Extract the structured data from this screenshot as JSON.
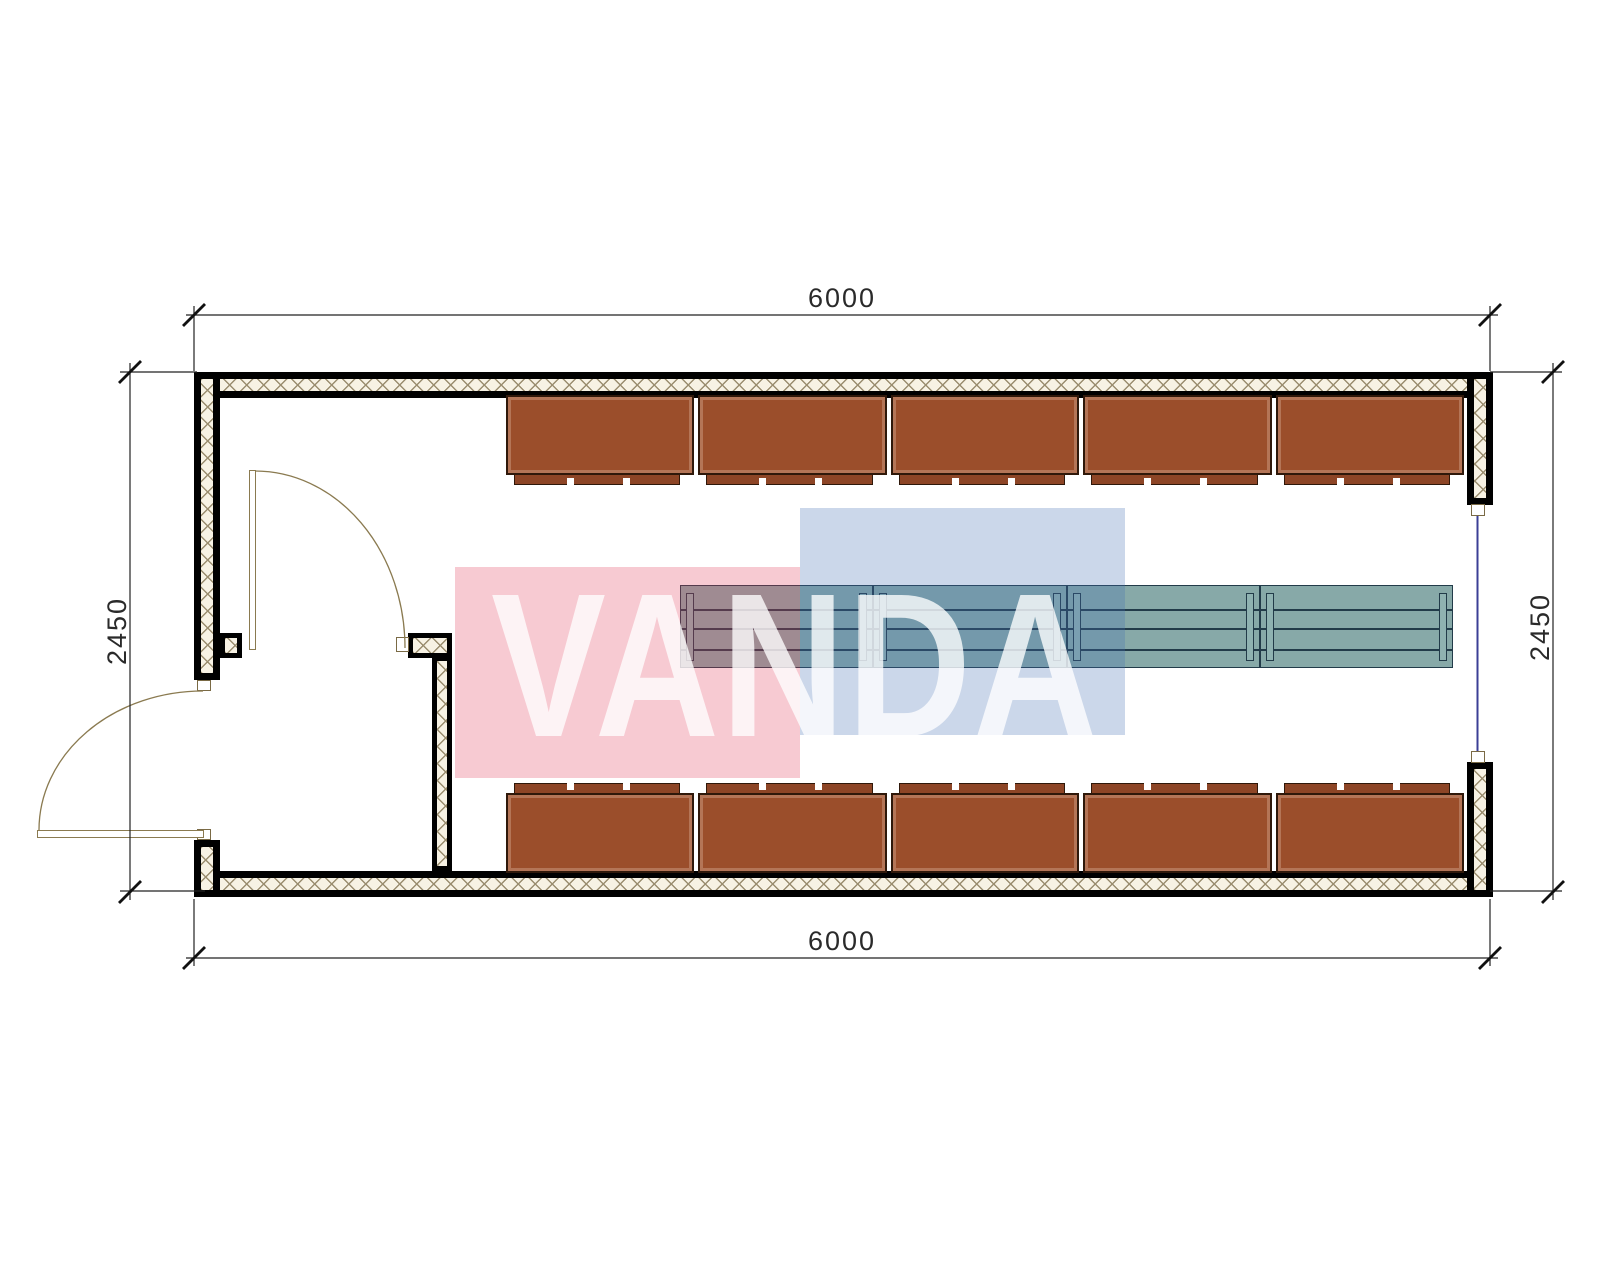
{
  "drawing": {
    "type": "floor-plan",
    "room_clear_span_note": "single rectangular module with entry vestibule"
  },
  "dimensions": {
    "top": "6000",
    "bottom": "6000",
    "left": "2450",
    "right": "2450"
  },
  "watermark": {
    "text": "VANDA",
    "red_square_color": "rgba(224,60,90,0.27)",
    "blue_square_color": "rgba(70,110,180,0.28)",
    "text_color": "rgba(255,255,255,0.78)"
  },
  "furniture": {
    "cabinet_rows": [
      {
        "position": "top",
        "units": 5
      },
      {
        "position": "bottom",
        "units": 5
      }
    ],
    "cabinet_color": "#9b4e2b",
    "cabinet_strip_color": "#8d4526",
    "cabinet_outline": "#2f180a",
    "work_tables": {
      "units": 4,
      "shelf_lines": 3
    },
    "table_color": "#87a9a8",
    "table_leg_color": "#8fb2b1",
    "table_outline": "#223b49"
  },
  "openings": {
    "doors": 2,
    "windows": 1,
    "door_line_color": "#8a7a50",
    "window_line_color": "#3b3f96"
  },
  "walls": {
    "outline_color": "#000000",
    "hatch_background": "#f7f2e4",
    "hatch_line_color": "#9a8d6f"
  },
  "annotation": {
    "line_color": "#222222"
  }
}
